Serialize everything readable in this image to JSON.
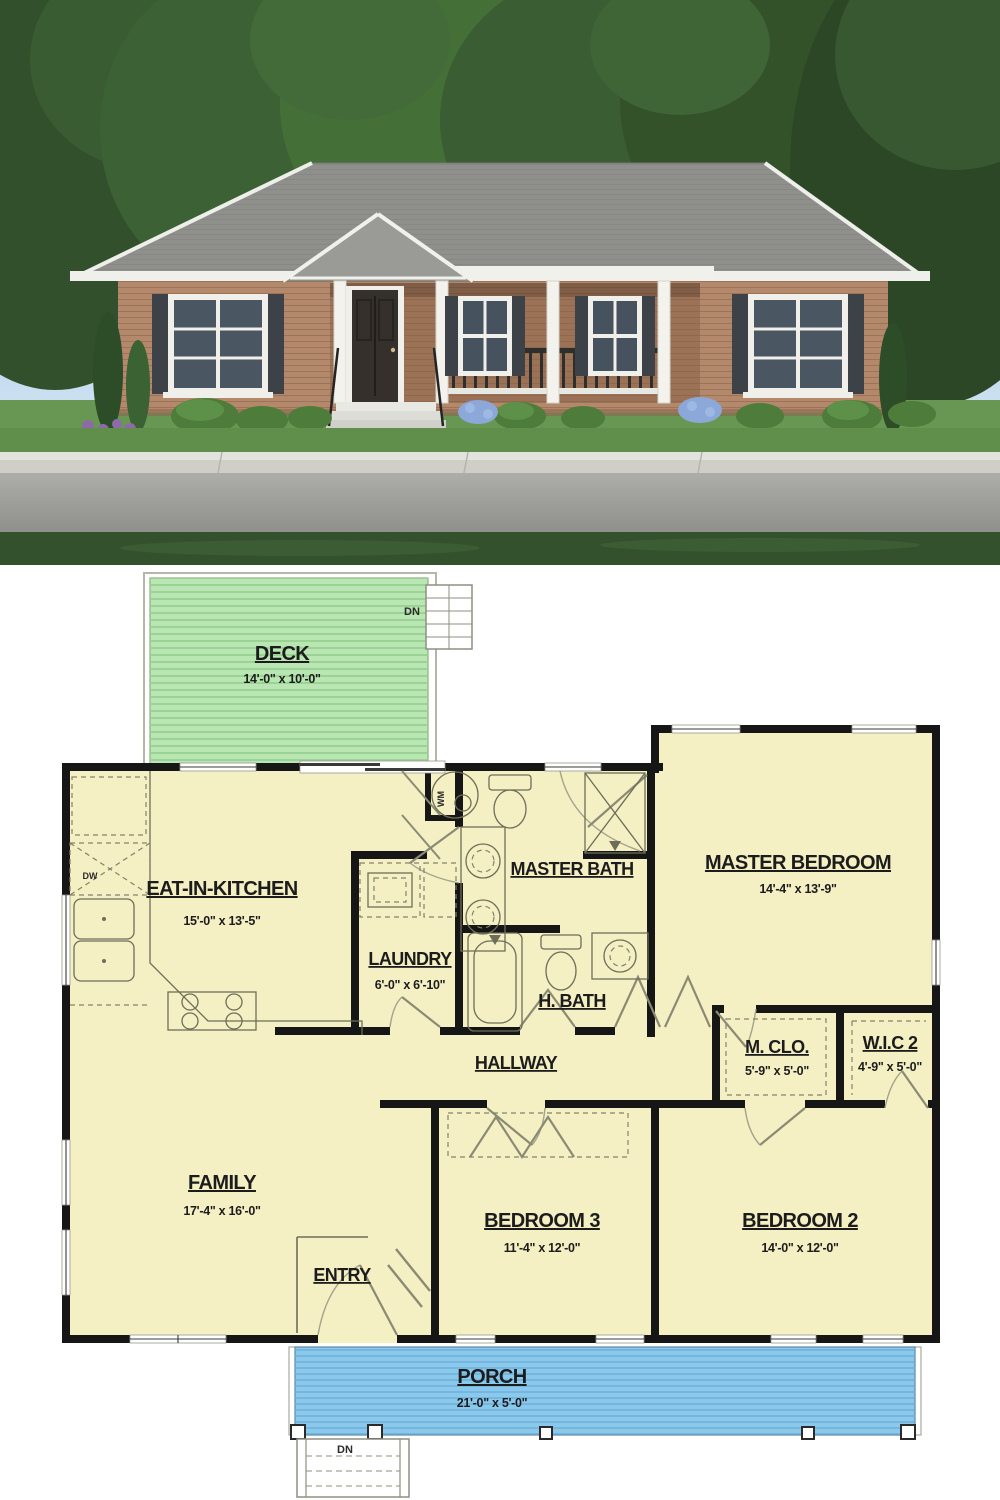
{
  "photo": {
    "colors": {
      "sky": "#9cc2e5",
      "roof": "#8f8f8b",
      "brick": "#b4886b",
      "porch_brick": "#9c7257",
      "trim": "#f1f1ec",
      "shutters": "#3d4248",
      "lawn": "#5f8f4b",
      "sidewalk": "#cfcfc8",
      "road": "#a5a5a1",
      "foreground_grass": "#33512c"
    }
  },
  "plan": {
    "colors": {
      "floor": "#f5efc4",
      "deck": "#b9e6b2",
      "porch": "#8bc9ec",
      "wall": "#161616"
    },
    "rooms": {
      "deck": {
        "name": "DECK",
        "dims": "14'-0\" x 10'-0\""
      },
      "kitchen": {
        "name": "EAT-IN-KITCHEN",
        "dims": "15'-0\" x 13'-5\""
      },
      "laundry": {
        "name": "LAUNDRY",
        "dims": "6'-0\" x 6'-10\""
      },
      "master_bath": {
        "name": "MASTER BATH"
      },
      "master_bedroom": {
        "name": "MASTER BEDROOM",
        "dims": "14'-4\" x 13'-9\""
      },
      "h_bath": {
        "name": "H. BATH"
      },
      "hallway": {
        "name": "HALLWAY"
      },
      "m_clo": {
        "name": "M. CLO.",
        "dims": "5'-9\" x 5'-0\""
      },
      "wic2": {
        "name": "W.I.C 2",
        "dims": "4'-9\" x 5'-0\""
      },
      "family": {
        "name": "FAMILY",
        "dims": "17'-4\" x 16'-0\""
      },
      "entry": {
        "name": "ENTRY"
      },
      "bedroom3": {
        "name": "BEDROOM 3",
        "dims": "11'-4\" x 12'-0\""
      },
      "bedroom2": {
        "name": "BEDROOM 2",
        "dims": "14'-0\" x 12'-0\""
      },
      "porch": {
        "name": "PORCH",
        "dims": "21'-0\" x 5'-0\""
      }
    },
    "annotations": {
      "deck_stairs_dn": "DN",
      "porch_stairs_dn": "DN",
      "dishwasher": "DW",
      "washer": "WM"
    }
  }
}
